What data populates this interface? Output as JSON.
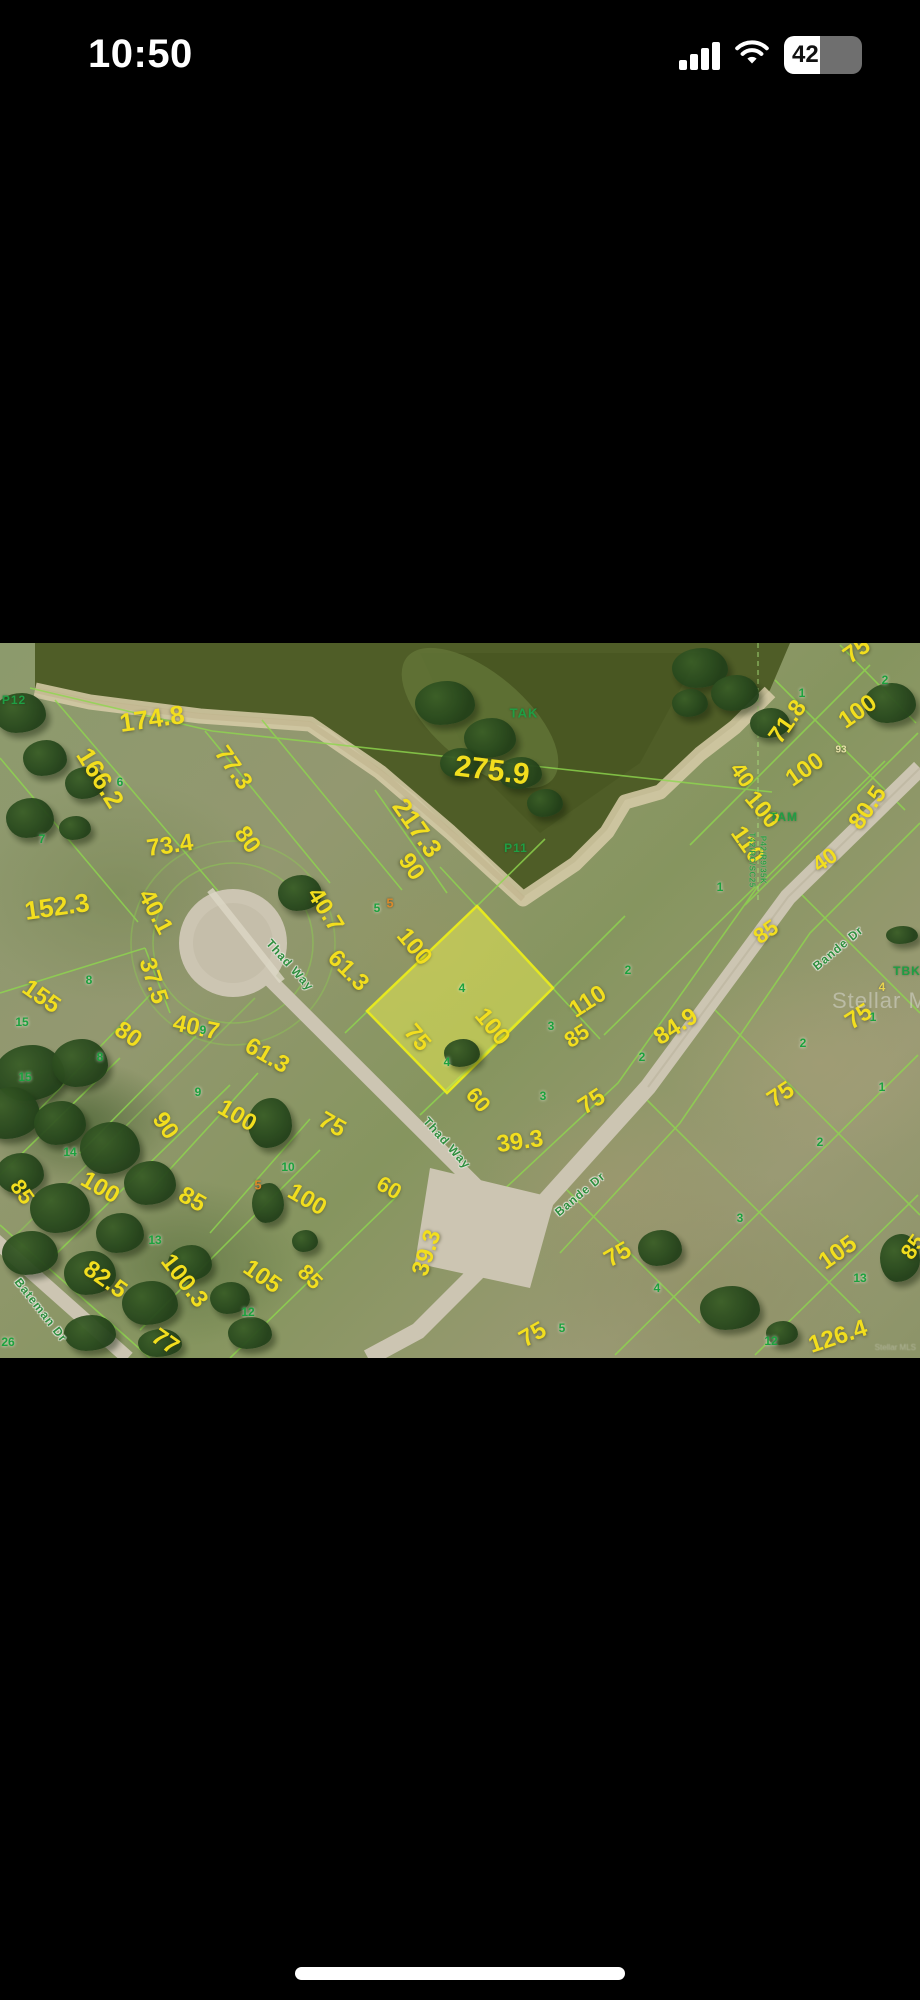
{
  "status_bar": {
    "time": "10:50",
    "battery_percent": "42"
  },
  "map": {
    "watermark": "Stellar MLS",
    "attribution": "Stellar MLS",
    "colors": {
      "dimension_text": "#f2de1e",
      "lot_number_text": "#1ca23e",
      "plat_line": "#8ed74e",
      "water": "#4f5d27",
      "sand_shore": "#d8cda9",
      "road": "#ccc5b2",
      "highlight_fill": "rgba(235,240,80,0.5)",
      "highlight_stroke": "#e6e81f"
    },
    "highlighted_parcel": {
      "lot_number": "4",
      "points": "477,263 553,345 447,450 367,368"
    },
    "labels": [
      {
        "t": "275.9",
        "x": 492,
        "y": 128,
        "r": 7,
        "s": 30,
        "k": "dim"
      },
      {
        "t": "174.8",
        "x": 152,
        "y": 76,
        "r": -8,
        "s": 26,
        "k": "dim"
      },
      {
        "t": "166.2",
        "x": 100,
        "y": 135,
        "r": 58,
        "s": 26,
        "k": "dim"
      },
      {
        "t": "77.3",
        "x": 233,
        "y": 125,
        "r": 55,
        "s": 24,
        "k": "dim"
      },
      {
        "t": "217.3",
        "x": 417,
        "y": 185,
        "r": 55,
        "s": 26,
        "k": "dim"
      },
      {
        "t": "73.4",
        "x": 170,
        "y": 203,
        "r": -8,
        "s": 24,
        "k": "dim"
      },
      {
        "t": "80",
        "x": 247,
        "y": 197,
        "r": 55,
        "s": 24,
        "k": "dim"
      },
      {
        "t": "90",
        "x": 411,
        "y": 224,
        "r": 55,
        "s": 24,
        "k": "dim"
      },
      {
        "t": "40.1",
        "x": 155,
        "y": 269,
        "r": 62,
        "s": 24,
        "k": "dim"
      },
      {
        "t": "152.3",
        "x": 57,
        "y": 264,
        "r": -8,
        "s": 26,
        "k": "dim"
      },
      {
        "t": "40.7",
        "x": 325,
        "y": 267,
        "r": 58,
        "s": 24,
        "k": "dim"
      },
      {
        "t": "61.3",
        "x": 348,
        "y": 328,
        "r": 45,
        "s": 24,
        "k": "dim"
      },
      {
        "t": "100",
        "x": 414,
        "y": 304,
        "r": 50,
        "s": 24,
        "k": "dim"
      },
      {
        "t": "155",
        "x": 41,
        "y": 354,
        "r": 35,
        "s": 24,
        "k": "dim"
      },
      {
        "t": "37.5",
        "x": 153,
        "y": 338,
        "r": 72,
        "s": 24,
        "k": "dim"
      },
      {
        "t": "40.7",
        "x": 196,
        "y": 385,
        "r": 12,
        "s": 24,
        "k": "dim"
      },
      {
        "t": "61.3",
        "x": 267,
        "y": 413,
        "r": 30,
        "s": 24,
        "k": "dim"
      },
      {
        "t": "80",
        "x": 128,
        "y": 392,
        "r": 35,
        "s": 24,
        "k": "dim"
      },
      {
        "t": "90",
        "x": 165,
        "y": 483,
        "r": 55,
        "s": 24,
        "k": "dim"
      },
      {
        "t": "100",
        "x": 237,
        "y": 473,
        "r": 30,
        "s": 24,
        "k": "dim"
      },
      {
        "t": "100",
        "x": 492,
        "y": 384,
        "r": 50,
        "s": 24,
        "k": "dim"
      },
      {
        "t": "75",
        "x": 417,
        "y": 395,
        "r": 50,
        "s": 24,
        "k": "dim"
      },
      {
        "t": "60",
        "x": 478,
        "y": 457,
        "r": 50,
        "s": 22,
        "k": "dim"
      },
      {
        "t": "39.3",
        "x": 520,
        "y": 499,
        "r": -8,
        "s": 24,
        "k": "dim"
      },
      {
        "t": "75",
        "x": 332,
        "y": 482,
        "r": 30,
        "s": 24,
        "k": "dim"
      },
      {
        "t": "100",
        "x": 307,
        "y": 557,
        "r": 30,
        "s": 24,
        "k": "dim"
      },
      {
        "t": "60",
        "x": 389,
        "y": 545,
        "r": 30,
        "s": 22,
        "k": "dim"
      },
      {
        "t": "39.3",
        "x": 427,
        "y": 610,
        "r": -72,
        "s": 24,
        "k": "dim"
      },
      {
        "t": "75",
        "x": 533,
        "y": 692,
        "r": -30,
        "s": 24,
        "k": "dim"
      },
      {
        "t": "75",
        "x": 618,
        "y": 612,
        "r": -30,
        "s": 24,
        "k": "dim"
      },
      {
        "t": "85",
        "x": 22,
        "y": 549,
        "r": 55,
        "s": 22,
        "k": "dim"
      },
      {
        "t": "100",
        "x": 100,
        "y": 545,
        "r": 30,
        "s": 24,
        "k": "dim"
      },
      {
        "t": "85",
        "x": 192,
        "y": 557,
        "r": 30,
        "s": 24,
        "k": "dim"
      },
      {
        "t": "82.5",
        "x": 105,
        "y": 637,
        "r": 35,
        "s": 24,
        "k": "dim"
      },
      {
        "t": "100.3",
        "x": 184,
        "y": 638,
        "r": 52,
        "s": 24,
        "k": "dim"
      },
      {
        "t": "105",
        "x": 262,
        "y": 634,
        "r": 35,
        "s": 24,
        "k": "dim"
      },
      {
        "t": "85",
        "x": 310,
        "y": 634,
        "r": 45,
        "s": 22,
        "k": "dim"
      },
      {
        "t": "77",
        "x": 165,
        "y": 699,
        "r": 35,
        "s": 24,
        "k": "dim"
      },
      {
        "t": "110",
        "x": 588,
        "y": 359,
        "r": -33,
        "s": 24,
        "k": "dim"
      },
      {
        "t": "85",
        "x": 577,
        "y": 393,
        "r": -33,
        "s": 22,
        "k": "dim"
      },
      {
        "t": "84.9",
        "x": 676,
        "y": 384,
        "r": -33,
        "s": 24,
        "k": "dim"
      },
      {
        "t": "75",
        "x": 592,
        "y": 459,
        "r": -33,
        "s": 24,
        "k": "dim"
      },
      {
        "t": "75",
        "x": 859,
        "y": 374,
        "r": -33,
        "s": 24,
        "k": "dim"
      },
      {
        "t": "75",
        "x": 781,
        "y": 452,
        "r": -33,
        "s": 24,
        "k": "dim"
      },
      {
        "t": "105",
        "x": 838,
        "y": 610,
        "r": -35,
        "s": 24,
        "k": "dim"
      },
      {
        "t": "126.4",
        "x": 838,
        "y": 694,
        "r": -18,
        "s": 24,
        "k": "dim"
      },
      {
        "t": "85",
        "x": 913,
        "y": 604,
        "r": -55,
        "s": 22,
        "k": "dim"
      },
      {
        "t": "71.8",
        "x": 788,
        "y": 79,
        "r": -55,
        "s": 24,
        "k": "dim"
      },
      {
        "t": "100",
        "x": 858,
        "y": 69,
        "r": -35,
        "s": 24,
        "k": "dim"
      },
      {
        "t": "40",
        "x": 742,
        "y": 132,
        "r": 55,
        "s": 22,
        "k": "dim"
      },
      {
        "t": "100",
        "x": 805,
        "y": 127,
        "r": -35,
        "s": 24,
        "k": "dim"
      },
      {
        "t": "100",
        "x": 762,
        "y": 167,
        "r": 50,
        "s": 24,
        "k": "dim"
      },
      {
        "t": "110",
        "x": 747,
        "y": 202,
        "r": 55,
        "s": 24,
        "k": "dim"
      },
      {
        "t": "80.5",
        "x": 868,
        "y": 165,
        "r": -55,
        "s": 24,
        "k": "dim"
      },
      {
        "t": "40",
        "x": 825,
        "y": 217,
        "r": -35,
        "s": 22,
        "k": "dim"
      },
      {
        "t": "85",
        "x": 766,
        "y": 289,
        "r": -35,
        "s": 22,
        "k": "dim"
      },
      {
        "t": "75",
        "x": 857,
        "y": 8,
        "r": -35,
        "s": 24,
        "k": "dim"
      },
      {
        "t": "93",
        "x": 841,
        "y": 107,
        "r": 0,
        "s": 10,
        "k": "pale"
      },
      {
        "t": "TAK",
        "x": 524,
        "y": 70,
        "r": 0,
        "s": 13,
        "k": "area"
      },
      {
        "t": "P11",
        "x": 516,
        "y": 205,
        "r": 0,
        "s": 12,
        "k": "area"
      },
      {
        "t": "P12",
        "x": 14,
        "y": 57,
        "r": 0,
        "s": 12,
        "k": "area"
      },
      {
        "t": "TAM",
        "x": 784,
        "y": 174,
        "r": 0,
        "s": 12,
        "k": "area"
      },
      {
        "t": "TBK",
        "x": 907,
        "y": 328,
        "r": 0,
        "s": 12,
        "k": "area"
      },
      {
        "t": "6",
        "x": 120,
        "y": 139,
        "r": 0,
        "s": 12,
        "k": "lot"
      },
      {
        "t": "7",
        "x": 42,
        "y": 196,
        "r": 0,
        "s": 12,
        "k": "lot"
      },
      {
        "t": "5",
        "x": 377,
        "y": 265,
        "r": 0,
        "s": 12,
        "k": "lot"
      },
      {
        "t": "8",
        "x": 89,
        "y": 337,
        "r": 0,
        "s": 12,
        "k": "lot"
      },
      {
        "t": "15",
        "x": 22,
        "y": 379,
        "r": 0,
        "s": 12,
        "k": "lot"
      },
      {
        "t": "15",
        "x": 25,
        "y": 434,
        "r": 0,
        "s": 12,
        "k": "lot"
      },
      {
        "t": "9",
        "x": 203,
        "y": 387,
        "r": 0,
        "s": 12,
        "k": "lot"
      },
      {
        "t": "9",
        "x": 198,
        "y": 449,
        "r": 0,
        "s": 12,
        "k": "lot"
      },
      {
        "t": "8",
        "x": 100,
        "y": 414,
        "r": 0,
        "s": 12,
        "k": "lot"
      },
      {
        "t": "14",
        "x": 70,
        "y": 509,
        "r": 0,
        "s": 12,
        "k": "lot"
      },
      {
        "t": "10",
        "x": 288,
        "y": 524,
        "r": 0,
        "s": 12,
        "k": "lot"
      },
      {
        "t": "13",
        "x": 155,
        "y": 597,
        "r": 0,
        "s": 12,
        "k": "lot"
      },
      {
        "t": "12",
        "x": 248,
        "y": 669,
        "r": 0,
        "s": 12,
        "k": "lot"
      },
      {
        "t": "26",
        "x": 8,
        "y": 699,
        "r": 0,
        "s": 12,
        "k": "lot"
      },
      {
        "t": "4",
        "x": 462,
        "y": 345,
        "r": 0,
        "s": 12,
        "k": "lot"
      },
      {
        "t": "4",
        "x": 447,
        "y": 419,
        "r": 0,
        "s": 12,
        "k": "lot"
      },
      {
        "t": "3",
        "x": 551,
        "y": 383,
        "r": 0,
        "s": 12,
        "k": "lot"
      },
      {
        "t": "3",
        "x": 543,
        "y": 453,
        "r": 0,
        "s": 12,
        "k": "lot"
      },
      {
        "t": "2",
        "x": 628,
        "y": 327,
        "r": 0,
        "s": 12,
        "k": "lot"
      },
      {
        "t": "2",
        "x": 642,
        "y": 414,
        "r": 0,
        "s": 12,
        "k": "lot"
      },
      {
        "t": "2",
        "x": 803,
        "y": 400,
        "r": 0,
        "s": 12,
        "k": "lot"
      },
      {
        "t": "1",
        "x": 873,
        "y": 374,
        "r": 0,
        "s": 12,
        "k": "lot"
      },
      {
        "t": "1",
        "x": 882,
        "y": 444,
        "r": 0,
        "s": 12,
        "k": "lot"
      },
      {
        "t": "2",
        "x": 820,
        "y": 499,
        "r": 0,
        "s": 12,
        "k": "lot"
      },
      {
        "t": "1",
        "x": 802,
        "y": 50,
        "r": 0,
        "s": 12,
        "k": "lot"
      },
      {
        "t": "2",
        "x": 885,
        "y": 37,
        "r": 0,
        "s": 12,
        "k": "lot"
      },
      {
        "t": "1",
        "x": 720,
        "y": 244,
        "r": 0,
        "s": 12,
        "k": "lot"
      },
      {
        "t": "3",
        "x": 740,
        "y": 575,
        "r": 0,
        "s": 12,
        "k": "lot"
      },
      {
        "t": "13",
        "x": 860,
        "y": 635,
        "r": 0,
        "s": 12,
        "k": "lot"
      },
      {
        "t": "12",
        "x": 771,
        "y": 698,
        "r": 0,
        "s": 12,
        "k": "lot"
      },
      {
        "t": "5",
        "x": 562,
        "y": 685,
        "r": 0,
        "s": 12,
        "k": "lot"
      },
      {
        "t": "4",
        "x": 657,
        "y": 645,
        "r": 0,
        "s": 12,
        "k": "lot"
      },
      {
        "t": "5",
        "x": 390,
        "y": 260,
        "r": 0,
        "s": 13,
        "k": "morange"
      },
      {
        "t": "5",
        "x": 258,
        "y": 542,
        "r": 0,
        "s": 13,
        "k": "morange"
      },
      {
        "t": "4",
        "x": 882,
        "y": 344,
        "r": 0,
        "s": 12,
        "k": "myellow"
      },
      {
        "t": "Thad Way",
        "x": 290,
        "y": 322,
        "r": 48,
        "s": 12,
        "k": "street"
      },
      {
        "t": "Thad Way",
        "x": 447,
        "y": 500,
        "r": 48,
        "s": 12,
        "k": "street"
      },
      {
        "t": "Bande Dr",
        "x": 838,
        "y": 305,
        "r": -40,
        "s": 12,
        "k": "street"
      },
      {
        "t": "Bande Dr",
        "x": 580,
        "y": 551,
        "r": -40,
        "s": 12,
        "k": "street"
      },
      {
        "t": "Bateman Dr",
        "x": 41,
        "y": 667,
        "r": 52,
        "s": 12,
        "k": "street"
      },
      {
        "t": "T42/RC/SC25",
        "x": 752,
        "y": 217,
        "r": 90,
        "s": 8,
        "k": "ref"
      },
      {
        "t": "P42/R9/35K",
        "x": 763,
        "y": 217,
        "r": 90,
        "s": 8,
        "k": "ref"
      }
    ],
    "trees": [
      [
        20,
        70,
        26,
        20
      ],
      [
        45,
        115,
        22,
        18
      ],
      [
        85,
        140,
        20,
        16
      ],
      [
        30,
        175,
        24,
        20
      ],
      [
        75,
        185,
        16,
        12
      ],
      [
        445,
        60,
        30,
        22
      ],
      [
        490,
        95,
        26,
        20
      ],
      [
        520,
        130,
        22,
        16
      ],
      [
        545,
        160,
        18,
        14
      ],
      [
        460,
        120,
        20,
        15
      ],
      [
        700,
        25,
        28,
        20
      ],
      [
        735,
        50,
        24,
        18
      ],
      [
        770,
        80,
        20,
        15
      ],
      [
        690,
        60,
        18,
        14
      ],
      [
        890,
        60,
        26,
        20
      ],
      [
        300,
        250,
        22,
        18
      ],
      [
        462,
        410,
        18,
        14
      ],
      [
        902,
        292,
        16,
        9
      ],
      [
        270,
        480,
        22,
        25
      ],
      [
        268,
        560,
        16,
        20
      ],
      [
        305,
        598,
        13,
        11
      ],
      [
        30,
        430,
        35,
        28
      ],
      [
        80,
        420,
        28,
        24
      ],
      [
        10,
        470,
        30,
        26
      ],
      [
        60,
        480,
        26,
        22
      ],
      [
        110,
        505,
        30,
        26
      ],
      [
        20,
        530,
        24,
        20
      ],
      [
        150,
        540,
        26,
        22
      ],
      [
        60,
        565,
        30,
        25
      ],
      [
        120,
        590,
        24,
        20
      ],
      [
        30,
        610,
        28,
        22
      ],
      [
        90,
        630,
        26,
        22
      ],
      [
        190,
        620,
        22,
        18
      ],
      [
        150,
        660,
        28,
        22
      ],
      [
        230,
        655,
        20,
        16
      ],
      [
        250,
        690,
        22,
        16
      ],
      [
        90,
        690,
        26,
        18
      ],
      [
        160,
        700,
        22,
        14
      ],
      [
        660,
        605,
        22,
        18
      ],
      [
        900,
        615,
        20,
        24
      ],
      [
        730,
        665,
        30,
        22
      ],
      [
        782,
        690,
        16,
        12
      ]
    ]
  },
  "home_indicator": {
    "present": true
  }
}
